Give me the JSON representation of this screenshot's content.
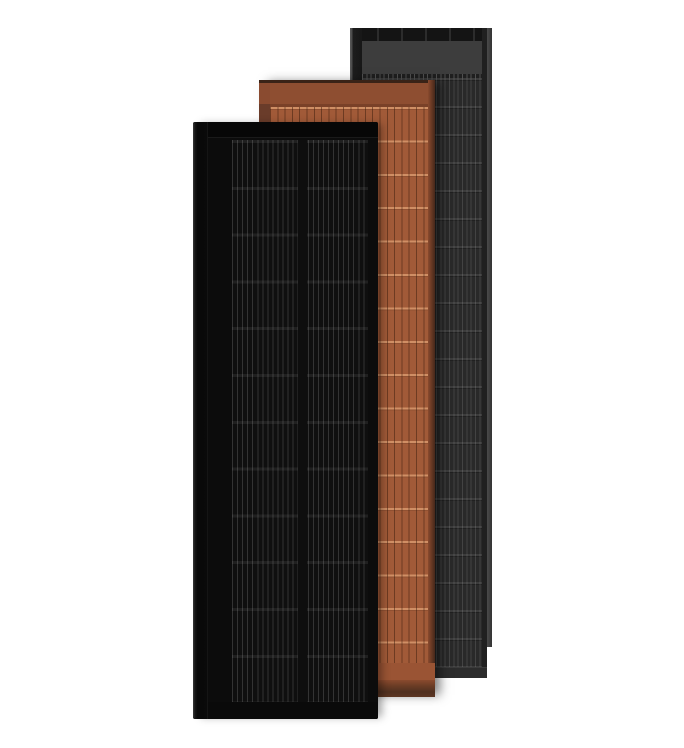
{
  "scene": {
    "description": "Product render of three overlapping vertical roof-integrated solar panel tiles on a plain white background",
    "background_color": "#ffffff",
    "panels": [
      {
        "name": "black-solar-panel",
        "label": "All-black solar panel",
        "position": "front left",
        "rows": 12,
        "column_groups": 2,
        "colors": {
          "frame": "#0c0c0c",
          "cells": "#0f0f0f",
          "grid_line": "#3a3a3a"
        }
      },
      {
        "name": "terracotta-solar-panel",
        "label": "Terracotta solar panel",
        "position": "middle",
        "rows": 17,
        "column_groups": 1,
        "colors": {
          "frame": "#8e4e31",
          "cells": "#a15a38",
          "grid_line": "#7c4227",
          "row_tick": "#c98a5e",
          "side": "#5f3727",
          "bottom_shade": "#503020"
        }
      },
      {
        "name": "gray-solar-panel",
        "label": "Dark gray solar panel",
        "position": "back right",
        "rows": 21,
        "column_groups": 1,
        "colors": {
          "frame": "#141414",
          "header": "#3d3d3d",
          "cells": "#292929",
          "grid_line": "#474747",
          "edge": "#4a4a4a"
        }
      }
    ]
  }
}
